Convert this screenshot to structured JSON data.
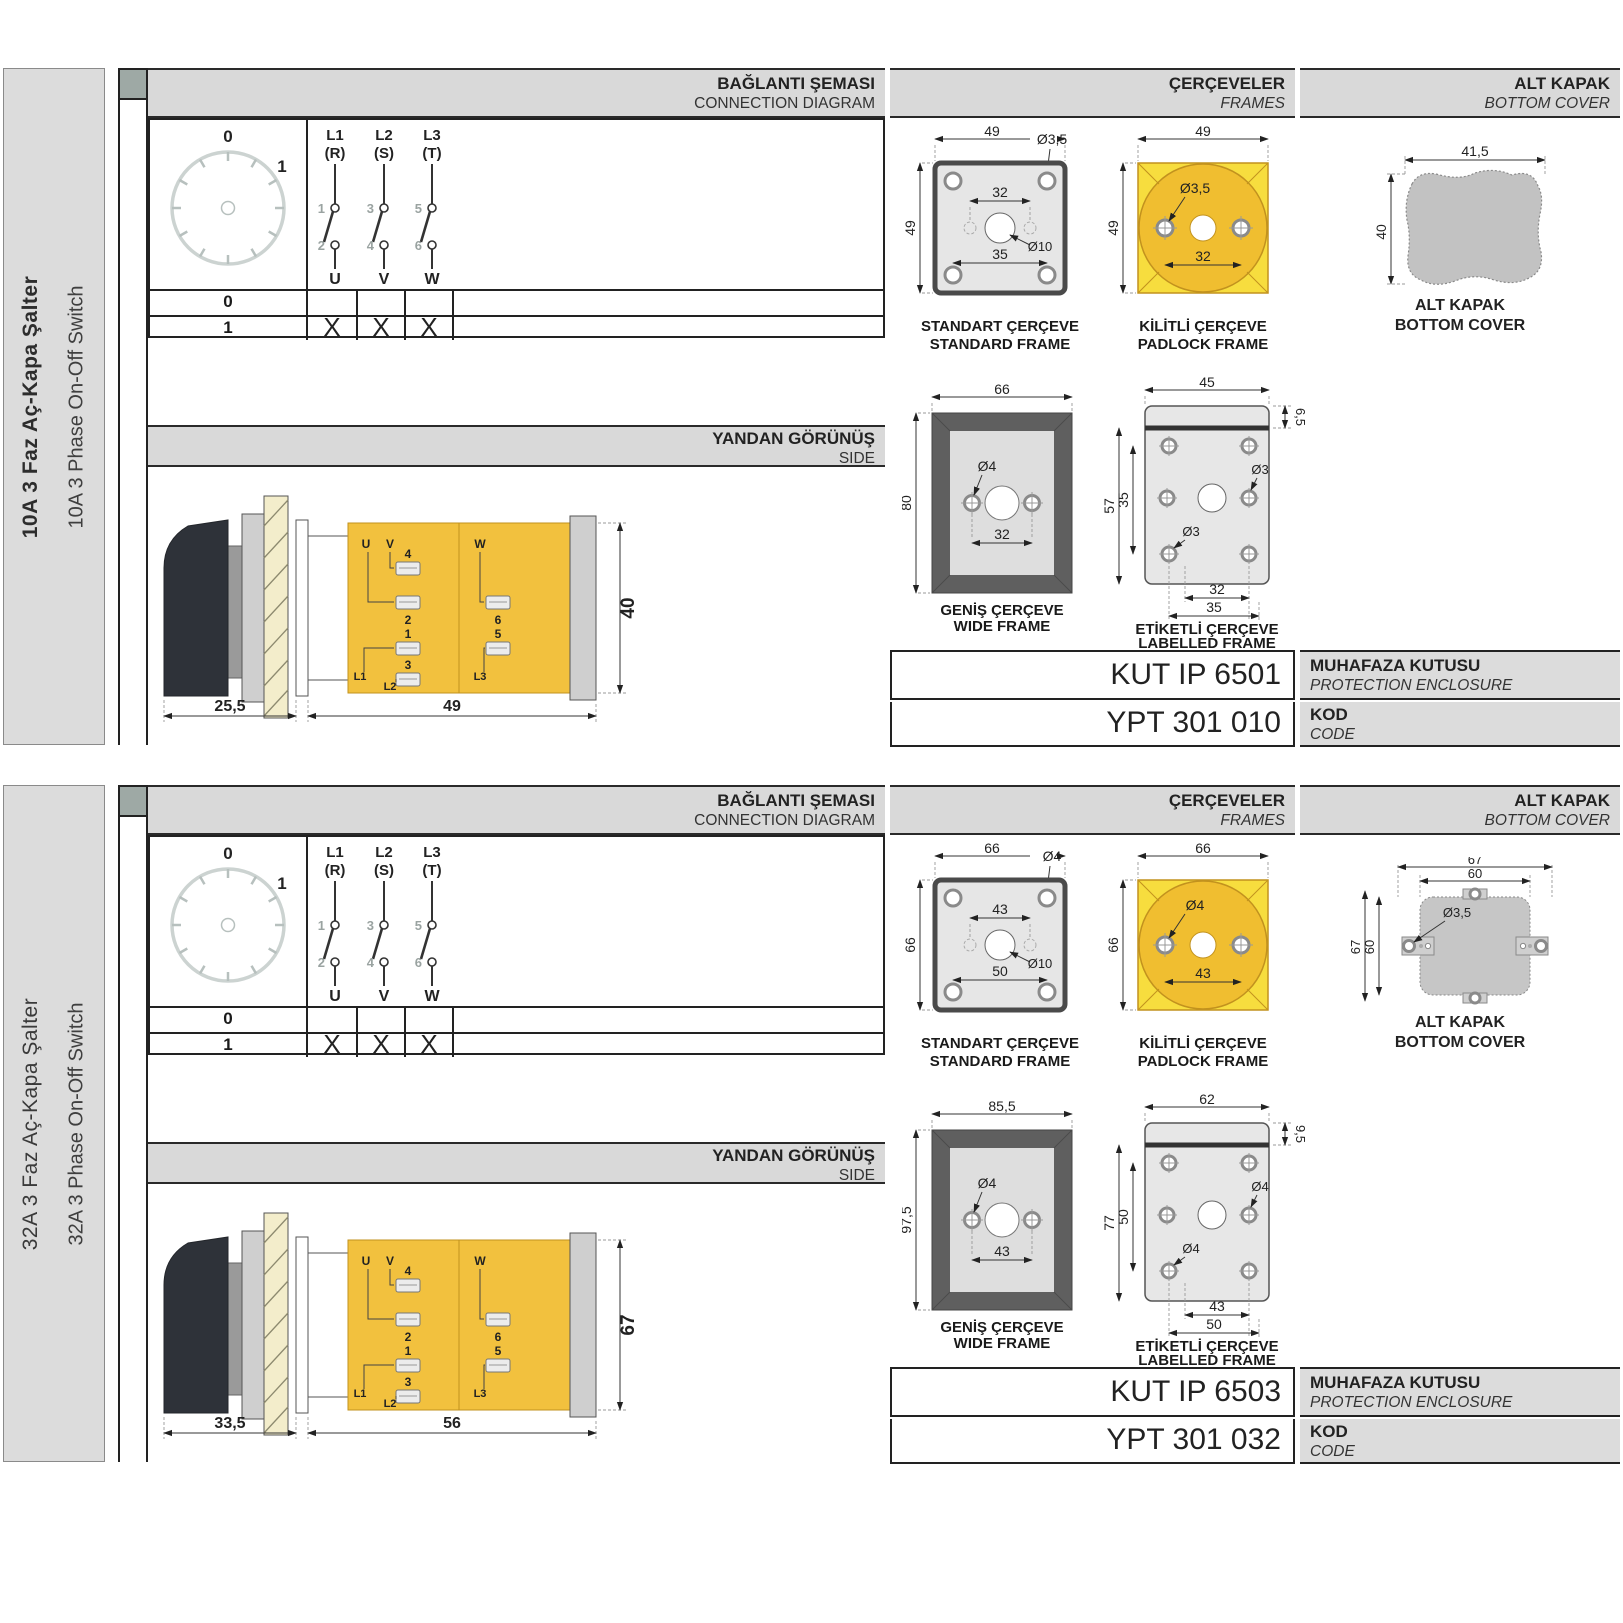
{
  "colors": {
    "frame_yellow_square": "#F7DD3E",
    "frame_gold_circle": "#F0BE30",
    "body_yellow": "#F2C13E",
    "band_gray": "#D9D9D9",
    "drawing_dark_gray": "#5F5F5F",
    "spine_tab_gray": "#9EA9A5"
  },
  "products": [
    {
      "sidebar": {
        "title_tr": "10A 3 Faz Aç-Kapa Şalter",
        "title_en": "10A 3 Phase On-Off Switch"
      },
      "headers": {
        "connection_tr": "BAĞLANTI ŞEMASI",
        "connection_en": "CONNECTION DIAGRAM",
        "frames_tr": "ÇERÇEVELER",
        "frames_en": "FRAMES",
        "cover_tr": "ALT KAPAK",
        "cover_en": "BOTTOM COVER",
        "side_tr": "YANDAN GÖRÜNÜŞ",
        "side_en": "SIDE"
      },
      "connection": {
        "dial": {
          "zero": "0",
          "one": "1"
        },
        "phases": [
          {
            "line": "L1",
            "phase": "(R)",
            "top_no": "1",
            "bottom_no": "2",
            "output": "U"
          },
          {
            "line": "L2",
            "phase": "(S)",
            "top_no": "3",
            "bottom_no": "4",
            "output": "V"
          },
          {
            "line": "L3",
            "phase": "(T)",
            "top_no": "5",
            "bottom_no": "6",
            "output": "W"
          }
        ],
        "table": {
          "row0": "0",
          "row1": "1",
          "marks": [
            "X",
            "X",
            "X"
          ]
        }
      },
      "side_view": {
        "dim_handle": "25,5",
        "dim_body": "49",
        "dim_height": "40",
        "labels": {
          "u": "U",
          "v": "V",
          "w": "W",
          "l1": "L1",
          "l2": "L2",
          "l3": "L3",
          "n1": "1",
          "n2": "2",
          "n3": "3",
          "n4": "4",
          "n5": "5",
          "n6": "6"
        }
      },
      "frames": {
        "standard": {
          "label_tr": "STANDART ÇERÇEVE",
          "label_en": "STANDARD FRAME",
          "width": "49",
          "height": "49",
          "top_span": "32",
          "bottom_span": "35",
          "corner_hole": "Ø3,5",
          "center_hole": "Ø10"
        },
        "padlock": {
          "label_tr": "KİLİTLİ ÇERÇEVE",
          "label_en": "PADLOCK FRAME",
          "width": "49",
          "height": "49",
          "hole": "Ø3,5",
          "span": "32"
        },
        "wide": {
          "label_tr": "GENİŞ ÇERÇEVE",
          "label_en": "WIDE FRAME",
          "width": "66",
          "height": "80",
          "hole": "Ø4",
          "span": "32"
        },
        "labelled": {
          "label_tr": "ETİKETLİ ÇERÇEVE",
          "label_en": "LABELLED FRAME",
          "width": "45",
          "height": "57",
          "inner_height": "35",
          "top_strip": "6,5",
          "hole_a": "Ø3",
          "hole_b": "Ø3",
          "span_a": "32",
          "span_b": "35"
        }
      },
      "cover": {
        "label_tr": "ALT KAPAK",
        "label_en": "BOTTOM COVER",
        "a": {
          "width": "41,5",
          "height": "40"
        }
      },
      "enclosure": {
        "code": "KUT IP 6501",
        "label_tr": "MUHAFAZA KUTUSU",
        "label_en": "PROTECTION ENCLOSURE"
      },
      "order_code": {
        "value": "YPT 301 010",
        "label_tr": "KOD",
        "label_en": "CODE"
      }
    },
    {
      "sidebar": {
        "title_tr": "32A 3 Faz Aç-Kapa Şalter",
        "title_en": "32A 3 Phase On-Off Switch"
      },
      "headers": {
        "connection_tr": "BAĞLANTI ŞEMASI",
        "connection_en": "CONNECTION DIAGRAM",
        "frames_tr": "ÇERÇEVELER",
        "frames_en": "FRAMES",
        "cover_tr": "ALT KAPAK",
        "cover_en": "BOTTOM COVER",
        "side_tr": "YANDAN GÖRÜNÜŞ",
        "side_en": "SIDE"
      },
      "connection": {
        "dial": {
          "zero": "0",
          "one": "1"
        },
        "phases": [
          {
            "line": "L1",
            "phase": "(R)",
            "top_no": "1",
            "bottom_no": "2",
            "output": "U"
          },
          {
            "line": "L2",
            "phase": "(S)",
            "top_no": "3",
            "bottom_no": "4",
            "output": "V"
          },
          {
            "line": "L3",
            "phase": "(T)",
            "top_no": "5",
            "bottom_no": "6",
            "output": "W"
          }
        ],
        "table": {
          "row0": "0",
          "row1": "1",
          "marks": [
            "X",
            "X",
            "X"
          ]
        }
      },
      "side_view": {
        "dim_handle": "33,5",
        "dim_body": "56",
        "dim_height": "67",
        "labels": {
          "u": "U",
          "v": "V",
          "w": "W",
          "l1": "L1",
          "l2": "L2",
          "l3": "L3",
          "n1": "1",
          "n2": "2",
          "n3": "3",
          "n4": "4",
          "n5": "5",
          "n6": "6"
        }
      },
      "frames": {
        "standard": {
          "label_tr": "STANDART ÇERÇEVE",
          "label_en": "STANDARD FRAME",
          "width": "66",
          "height": "66",
          "top_span": "43",
          "bottom_span": "50",
          "corner_hole": "Ø4",
          "center_hole": "Ø10"
        },
        "padlock": {
          "label_tr": "KİLİTLİ ÇERÇEVE",
          "label_en": "PADLOCK FRAME",
          "width": "66",
          "height": "66",
          "hole": "Ø4",
          "span": "43"
        },
        "wide": {
          "label_tr": "GENİŞ ÇERÇEVE",
          "label_en": "WIDE FRAME",
          "width": "85,5",
          "height": "97,5",
          "hole": "Ø4",
          "span": "43"
        },
        "labelled": {
          "label_tr": "ETİKETLİ ÇERÇEVE",
          "label_en": "LABELLED FRAME",
          "width": "62",
          "height": "77",
          "inner_height": "50",
          "top_strip": "9,5",
          "hole_a": "Ø4",
          "hole_b": "Ø4",
          "span_a": "43",
          "span_b": "50"
        }
      },
      "cover": {
        "label_tr": "ALT KAPAK",
        "label_en": "BOTTOM COVER",
        "b": {
          "outer_width": "67",
          "inner_width": "60",
          "outer_height": "67",
          "inner_height": "60",
          "hole": "Ø3,5"
        }
      },
      "enclosure": {
        "code": "KUT IP 6503",
        "label_tr": "MUHAFAZA KUTUSU",
        "label_en": "PROTECTION ENCLOSURE"
      },
      "order_code": {
        "value": "YPT 301 032",
        "label_tr": "KOD",
        "label_en": "CODE"
      }
    }
  ]
}
